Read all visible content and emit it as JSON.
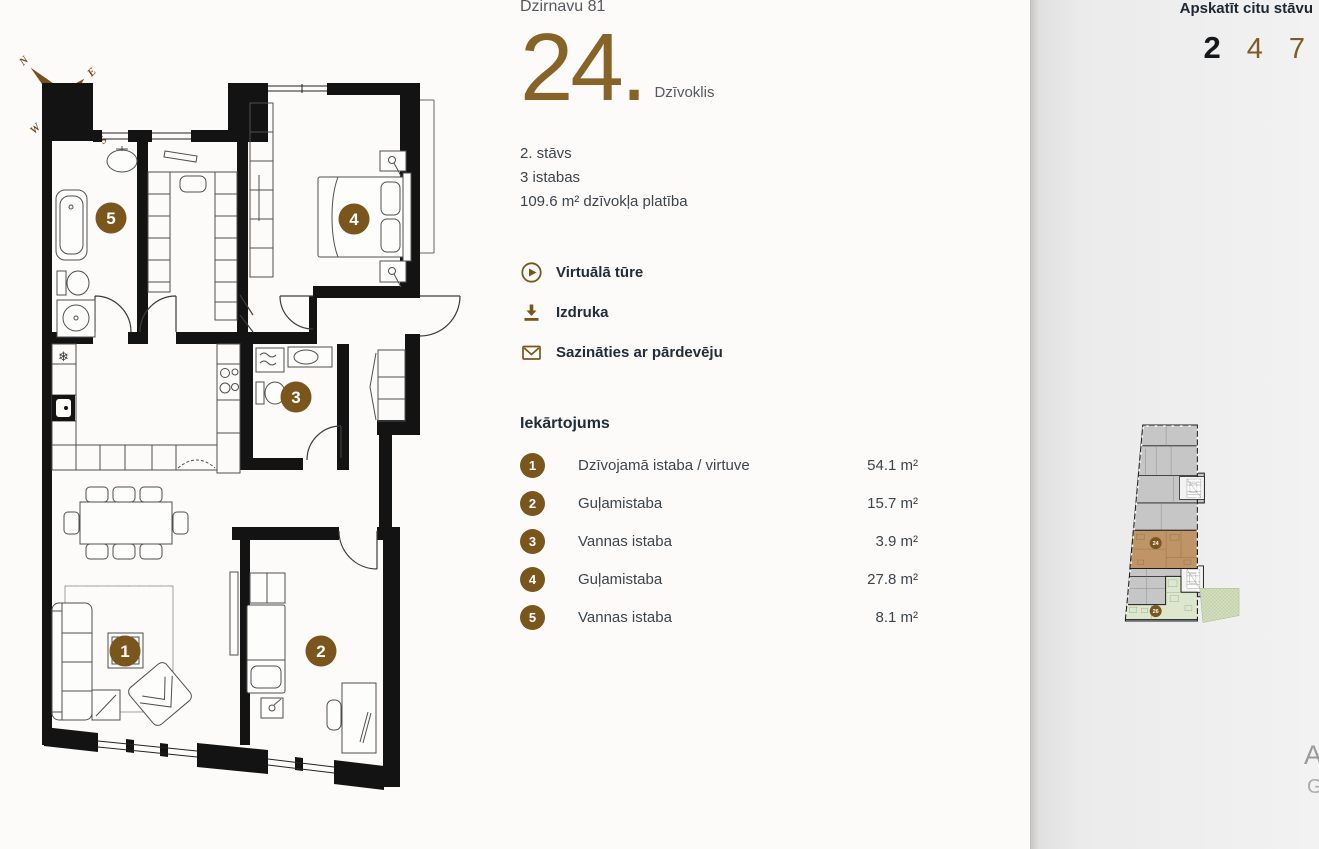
{
  "colors": {
    "accent": "#7a551c",
    "accent_number": "#876327",
    "dark_text": "#222d38",
    "body_text": "#3d444b",
    "muted_text": "#565a5f",
    "wall": "#131313",
    "mini_gray": "#c6c6c6",
    "mini_highlight": "#bf9467",
    "mini_secondary": "#dde7cd"
  },
  "compass": {
    "n": "N",
    "e": "E",
    "s": "S",
    "w": "W"
  },
  "header": {
    "address": "Dzirnavu 81",
    "apartment_number": "24.",
    "apartment_label": "Dzīvoklis"
  },
  "details": {
    "floor": "2. stāvs",
    "rooms": "3 istabas",
    "area": "109.6 m² dzīvokļa platība"
  },
  "actions": [
    {
      "icon": "play-icon",
      "label": "Virtuālā tūre"
    },
    {
      "icon": "download-icon",
      "label": "Izdruka"
    },
    {
      "icon": "envelope-icon",
      "label": "Sazināties ar pārdevēju"
    }
  ],
  "layout_section": {
    "title": "Iekārtojums",
    "rooms": [
      {
        "num": "1",
        "label": "Dzīvojamā istaba / virtuve",
        "area": "54.1 m²"
      },
      {
        "num": "2",
        "label": "Guļamistaba",
        "area": "15.7 m²"
      },
      {
        "num": "3",
        "label": "Vannas istaba",
        "area": "3.9 m²"
      },
      {
        "num": "4",
        "label": "Guļamistaba",
        "area": "27.8 m²"
      },
      {
        "num": "5",
        "label": "Vannas istaba",
        "area": "8.1 m²"
      }
    ]
  },
  "floor_selector": {
    "title": "Apskatīt citu stāvu",
    "floors": [
      {
        "label": "2",
        "active": true
      },
      {
        "label": "4",
        "active": false
      },
      {
        "label": "7",
        "active": false
      }
    ]
  },
  "mini_plan": {
    "current_apartment_badge": "24",
    "other_apartment_badge": "26"
  },
  "icons": {
    "fridge_glyph": "❄"
  },
  "watermark": {
    "line1": "Ac",
    "line2": "Go"
  }
}
